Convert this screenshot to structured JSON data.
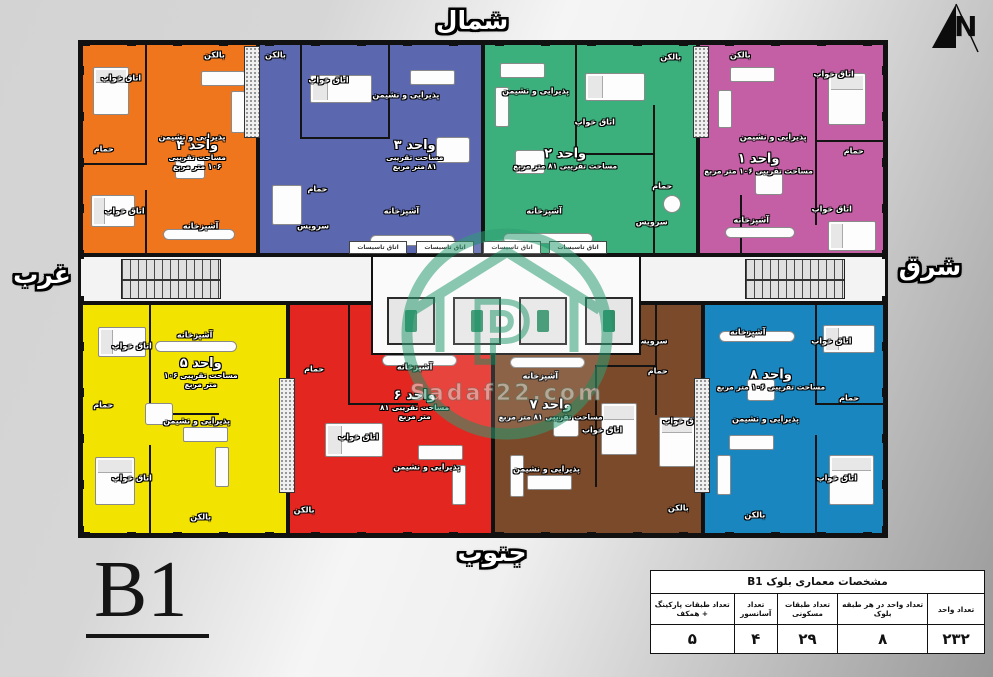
{
  "compass": {
    "north": "شمال",
    "south": "جنوب",
    "west": "غرب",
    "east": "شرق"
  },
  "plan_code": "B1",
  "watermark_text": "Sadaf22.com",
  "colors": {
    "unit1_pink": "#c45ea5",
    "unit2_green": "#3cb07c",
    "unit3_blue": "#5b68b0",
    "unit4_orange": "#f0761d",
    "unit5_yellow": "#f2e300",
    "unit6_red": "#e42620",
    "unit7_brown": "#7b4a2b",
    "unit8_cyan": "#1a86c0",
    "watermark_green": "#2f9e75"
  },
  "units": [
    {
      "id": 1,
      "name": "واحد ۱",
      "area": "مساحت تقریبی ۱۰۶ متر مربع",
      "color": "#c45ea5",
      "rooms": [
        {
          "label": "بالکن",
          "x": 22,
          "y": 5
        },
        {
          "label": "اتاق خواب",
          "x": 73,
          "y": 14
        },
        {
          "label": "پذیرایی و نشیمن",
          "x": 40,
          "y": 44
        },
        {
          "label": "حمام",
          "x": 84,
          "y": 51
        },
        {
          "label": "آشپزخانه",
          "x": 28,
          "y": 84
        },
        {
          "label": "اتاق خواب",
          "x": 72,
          "y": 79
        }
      ]
    },
    {
      "id": 2,
      "name": "واحد ۲",
      "area": "مساحت تقریبی ۸۱ متر مربع",
      "color": "#3cb07c",
      "rooms": [
        {
          "label": "پذیرایی و نشیمن",
          "x": 24,
          "y": 22
        },
        {
          "label": "اتاق خواب",
          "x": 52,
          "y": 37
        },
        {
          "label": "بالکن",
          "x": 88,
          "y": 6
        },
        {
          "label": "حمام",
          "x": 84,
          "y": 68
        },
        {
          "label": "سرویس",
          "x": 79,
          "y": 85
        },
        {
          "label": "آشپزخانه",
          "x": 28,
          "y": 80
        }
      ]
    },
    {
      "id": 3,
      "name": "واحد ۳",
      "area": "مساحت تقریبی ۸۱ متر مربع",
      "color": "#5b68b0",
      "rooms": [
        {
          "label": "بالکن",
          "x": 7,
          "y": 5
        },
        {
          "label": "اتاق خواب",
          "x": 31,
          "y": 17
        },
        {
          "label": "پذیرایی و نشیمن",
          "x": 66,
          "y": 24
        },
        {
          "label": "حمام",
          "x": 26,
          "y": 69
        },
        {
          "label": "سرویس",
          "x": 24,
          "y": 87
        },
        {
          "label": "آشپزخانه",
          "x": 64,
          "y": 80
        }
      ]
    },
    {
      "id": 4,
      "name": "واحد ۴",
      "area": "مساحت تقریبی ۱۰۶ متر مربع",
      "color": "#f0761d",
      "rooms": [
        {
          "label": "اتاق خواب",
          "x": 22,
          "y": 16
        },
        {
          "label": "بالکن",
          "x": 76,
          "y": 5
        },
        {
          "label": "پذیرایی و نشیمن",
          "x": 63,
          "y": 44
        },
        {
          "label": "حمام",
          "x": 12,
          "y": 50
        },
        {
          "label": "اتاق خواب",
          "x": 24,
          "y": 80
        },
        {
          "label": "آشپزخانه",
          "x": 68,
          "y": 87
        }
      ]
    },
    {
      "id": 5,
      "name": "واحد ۵",
      "area": "مساحت تقریبی ۱۰۶ متر مربع",
      "color": "#f2e300",
      "rooms": [
        {
          "label": "آشپزخانه",
          "x": 55,
          "y": 13
        },
        {
          "label": "اتاق خواب",
          "x": 24,
          "y": 18
        },
        {
          "label": "حمام",
          "x": 10,
          "y": 44
        },
        {
          "label": "پذیرایی و نشیمن",
          "x": 56,
          "y": 51
        },
        {
          "label": "اتاق خواب",
          "x": 24,
          "y": 76
        },
        {
          "label": "بالکن",
          "x": 58,
          "y": 93
        }
      ]
    },
    {
      "id": 6,
      "name": "واحد ۶",
      "area": "مساحت تقریبی ۸۱ متر مربع",
      "color": "#e42620",
      "rooms": [
        {
          "label": "حمام",
          "x": 12,
          "y": 28
        },
        {
          "label": "آشپزخانه",
          "x": 62,
          "y": 27
        },
        {
          "label": "اتاق خواب",
          "x": 34,
          "y": 58
        },
        {
          "label": "پذیرایی و نشیمن",
          "x": 68,
          "y": 71
        },
        {
          "label": "بالکن",
          "x": 7,
          "y": 90
        }
      ]
    },
    {
      "id": 7,
      "name": "واحد ۷",
      "area": "مساحت تقریبی ۸۱ متر مربع",
      "color": "#7b4a2b",
      "rooms": [
        {
          "label": "آشپزخانه",
          "x": 22,
          "y": 31
        },
        {
          "label": "سرویس",
          "x": 76,
          "y": 16
        },
        {
          "label": "حمام",
          "x": 79,
          "y": 29
        },
        {
          "label": "اتاق خواب",
          "x": 52,
          "y": 55
        },
        {
          "label": "اتاق خواب",
          "x": 91,
          "y": 51
        },
        {
          "label": "پذیرایی و نشیمن",
          "x": 25,
          "y": 72
        },
        {
          "label": "بالکن",
          "x": 89,
          "y": 89
        }
      ]
    },
    {
      "id": 8,
      "name": "واحد ۸",
      "area": "مساحت تقریبی ۱۰۶ متر مربع",
      "color": "#1a86c0",
      "rooms": [
        {
          "label": "آشپزخانه",
          "x": 24,
          "y": 12
        },
        {
          "label": "اتاق خواب",
          "x": 71,
          "y": 16
        },
        {
          "label": "حمام",
          "x": 81,
          "y": 41
        },
        {
          "label": "پذیرایی و نشیمن",
          "x": 34,
          "y": 50
        },
        {
          "label": "اتاق خواب",
          "x": 74,
          "y": 76
        },
        {
          "label": "بالکن",
          "x": 28,
          "y": 92
        }
      ]
    }
  ],
  "corridor": {
    "utility_label": "اتاق تاسیسات"
  },
  "spec_table": {
    "title": "مشخصات معماری بلوک B1",
    "columns": [
      {
        "label": "تعداد واحد",
        "value": "۲۳۲"
      },
      {
        "label": "تعداد واحد در هر طبقه بلوک",
        "value": "۸"
      },
      {
        "label": "تعداد طبقات مسکونی",
        "value": "۲۹"
      },
      {
        "label": "تعداد آسانسور",
        "value": "۴"
      },
      {
        "label": "تعداد طبقات پارکینگ + همکف",
        "value": "۵"
      }
    ]
  }
}
